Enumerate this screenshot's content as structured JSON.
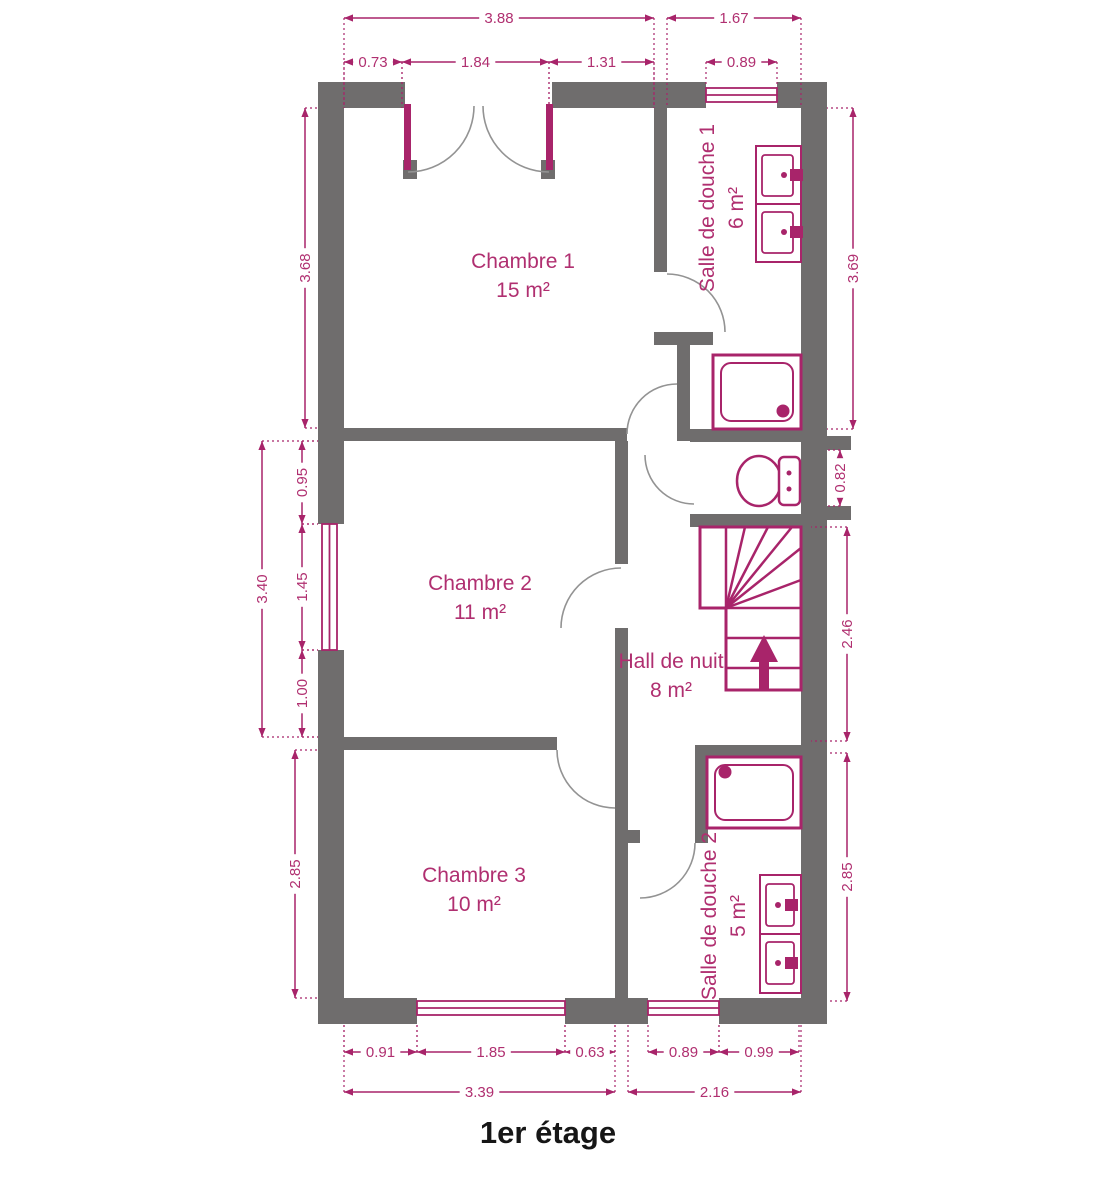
{
  "title": "1er étage",
  "colors": {
    "wall": "#6f6d6d",
    "accent": "#a8246a",
    "room_text": "#b02f70",
    "door_arc": "#939393",
    "title_text": "#161616"
  },
  "fixture_icons": [
    "shower-tray-icon",
    "washbasin-icon",
    "toilet-icon",
    "staircase-up-arrow-icon",
    "window-icon",
    "french-door-icon",
    "door-swing-icon"
  ],
  "rooms": [
    {
      "name": "Chambre 1",
      "area": "15 m²",
      "cx": 523,
      "cy": 268,
      "rotate": 0
    },
    {
      "name": "Salle de douche 1",
      "area": "6 m²",
      "cx": 714,
      "cy": 208,
      "rotate": -90
    },
    {
      "name": "Chambre 2",
      "area": "11 m²",
      "cx": 480,
      "cy": 590,
      "rotate": 0
    },
    {
      "name": "Hall de nuit",
      "area": "8 m²",
      "cx": 671,
      "cy": 668,
      "rotate": 0
    },
    {
      "name": "Chambre 3",
      "area": "10 m²",
      "cx": 474,
      "cy": 882,
      "rotate": 0
    },
    {
      "name": "Salle de douche 2",
      "area": "5 m²",
      "cx": 716,
      "cy": 916,
      "rotate": -90
    }
  ],
  "dimensions": [
    {
      "label": "3.88",
      "x1": 344,
      "y1": 18,
      "x2": 654,
      "y2": 18,
      "ext": "down",
      "extLen": 90
    },
    {
      "label": "1.67",
      "x1": 667,
      "y1": 18,
      "x2": 801,
      "y2": 18,
      "ext": "down",
      "extLen": 90
    },
    {
      "label": "0.73",
      "x1": 344,
      "y1": 62,
      "x2": 402,
      "y2": 62,
      "ext": "down",
      "extLen": 46
    },
    {
      "label": "1.84",
      "x1": 402,
      "y1": 62,
      "x2": 549,
      "y2": 62,
      "ext": "down",
      "extLen": 46
    },
    {
      "label": "1.31",
      "x1": 549,
      "y1": 62,
      "x2": 654,
      "y2": 62,
      "ext": "down",
      "extLen": 46
    },
    {
      "label": "0.89",
      "x1": 706,
      "y1": 62,
      "x2": 777,
      "y2": 62,
      "ext": "down",
      "extLen": 26
    },
    {
      "label": "3.68",
      "x1": 305,
      "y1": 108,
      "x2": 305,
      "y2": 428,
      "ext": "right",
      "extLen": 14
    },
    {
      "label": "3.40",
      "x1": 262,
      "y1": 441,
      "x2": 262,
      "y2": 737,
      "ext": "right",
      "extLen": 56
    },
    {
      "label": "0.95",
      "x1": 302,
      "y1": 441,
      "x2": 302,
      "y2": 524,
      "ext": "right",
      "extLen": 16
    },
    {
      "label": "1.45",
      "x1": 302,
      "y1": 524,
      "x2": 302,
      "y2": 650,
      "ext": "right",
      "extLen": 16
    },
    {
      "label": "1.00",
      "x1": 302,
      "y1": 650,
      "x2": 302,
      "y2": 737,
      "ext": "right",
      "extLen": 16
    },
    {
      "label": "2.85",
      "x1": 295,
      "y1": 750,
      "x2": 295,
      "y2": 998,
      "ext": "right",
      "extLen": 23
    },
    {
      "label": "3.69",
      "x1": 853,
      "y1": 108,
      "x2": 853,
      "y2": 429,
      "ext": "left",
      "extLen": 26
    },
    {
      "label": "0.82",
      "x1": 840,
      "y1": 450,
      "x2": 840,
      "y2": 506,
      "ext": "left",
      "extLen": 13
    },
    {
      "label": "2.46",
      "x1": 847,
      "y1": 527,
      "x2": 847,
      "y2": 741,
      "ext": "left",
      "extLen": 36
    },
    {
      "label": "2.85",
      "x1": 847,
      "y1": 753,
      "x2": 847,
      "y2": 1001,
      "ext": "left",
      "extLen": 20
    },
    {
      "label": "0.91",
      "x1": 344,
      "y1": 1052,
      "x2": 417,
      "y2": 1052,
      "ext": "up",
      "extLen": 28
    },
    {
      "label": "1.85",
      "x1": 417,
      "y1": 1052,
      "x2": 565,
      "y2": 1052,
      "ext": "up",
      "extLen": 28
    },
    {
      "label": "0.63",
      "x1": 565,
      "y1": 1052,
      "x2": 615,
      "y2": 1052,
      "ext": "up",
      "extLen": 28
    },
    {
      "label": "0.89",
      "x1": 648,
      "y1": 1052,
      "x2": 719,
      "y2": 1052,
      "ext": "up",
      "extLen": 28
    },
    {
      "label": "0.99",
      "x1": 719,
      "y1": 1052,
      "x2": 799,
      "y2": 1052,
      "ext": "up",
      "extLen": 28
    },
    {
      "label": "3.39",
      "x1": 344,
      "y1": 1092,
      "x2": 615,
      "y2": 1092,
      "ext": "up",
      "extLen": 68
    },
    {
      "label": "2.16",
      "x1": 628,
      "y1": 1092,
      "x2": 801,
      "y2": 1092,
      "ext": "up",
      "extLen": 68
    }
  ]
}
